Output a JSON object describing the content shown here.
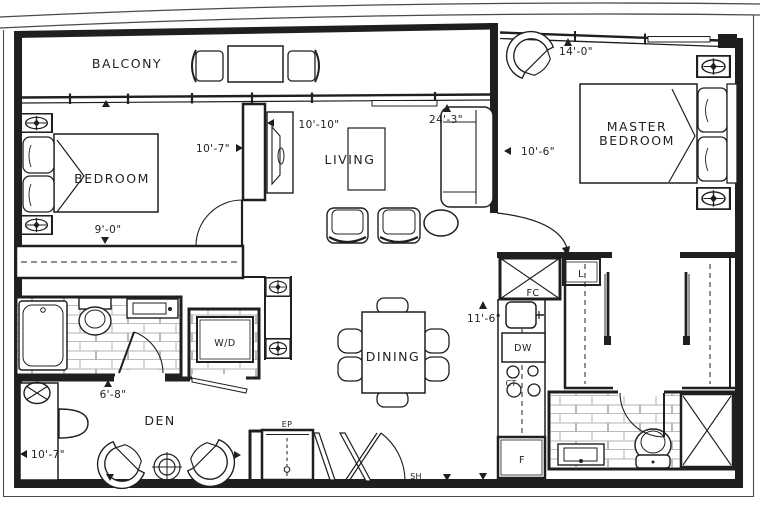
{
  "rooms": {
    "balcony": "BALCONY",
    "bedroom": "BEDROOM",
    "living": "LIVING",
    "master_line1": "MASTER",
    "master_line2": "BEDROOM",
    "dining": "DINING",
    "den": "DEN"
  },
  "fixtures": {
    "washer_dryer": "W/D",
    "fan_coil": "FC",
    "dishwasher": "DW",
    "cooktop": "CT",
    "fridge": "F",
    "linen_closet": "L",
    "electrical_panel": "EP",
    "shelf": "SH"
  },
  "dimensions": {
    "bedroom_width": "9'-0\"",
    "bedroom_depth": "10'-7\"",
    "living_width": "10'-10\"",
    "living_length": "24'-3\"",
    "master_width": "14'-0\"",
    "master_depth": "10'-6\"",
    "kitchen_length": "11'-6\"",
    "den_entry": "6'-8\"",
    "den_depth": "10'-7\""
  },
  "colors": {
    "line": "#1f1f1f",
    "tile": "#b3b3b3",
    "background": "#ffffff"
  }
}
